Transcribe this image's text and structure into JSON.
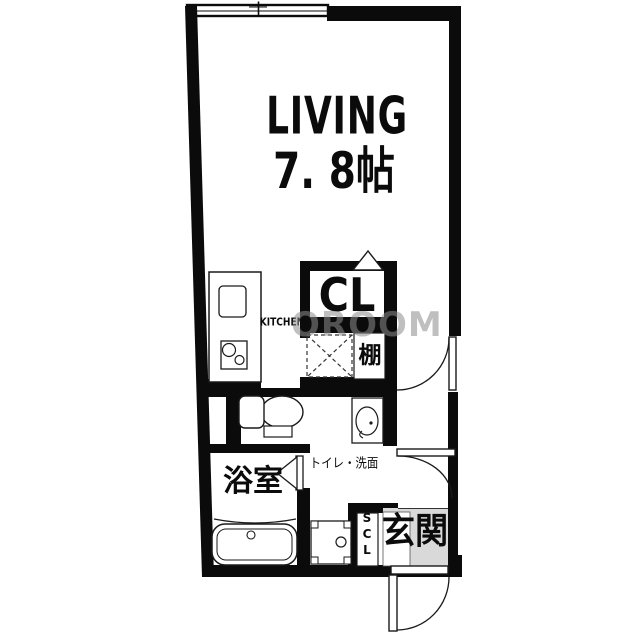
{
  "floor_plan": {
    "living_label": "LIVING",
    "living_size": "7. 8帖",
    "kitchen_label": "KITCHEN",
    "closet_label": "CL",
    "shelf_label": "棚",
    "toilet_washroom_label": "トイレ・洗面",
    "bathroom_label": "浴室",
    "shoe_closet_label": "SCL",
    "entrance_label": "玄関",
    "watermark": "OROOM"
  },
  "colors": {
    "wall": "#0b0b0b",
    "floor": "#ffffff",
    "entrance_floor": "#d9d9d9",
    "watermark": "#8c8c8c"
  }
}
